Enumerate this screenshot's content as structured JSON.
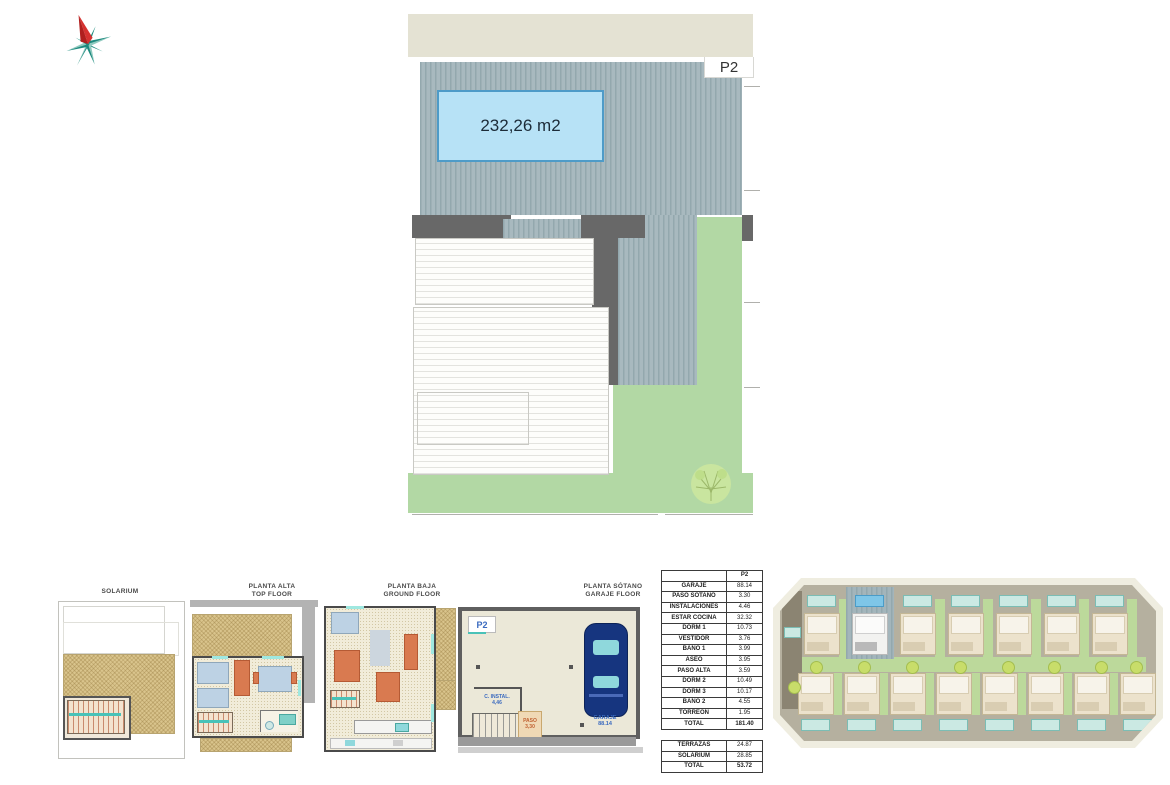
{
  "site_plan": {
    "plot_label": "P2",
    "area_label": "232,26 m2"
  },
  "floor_plans": [
    {
      "id": "solarium",
      "title_lines": [
        "SOLARIUM"
      ]
    },
    {
      "id": "planta-alta",
      "title_lines": [
        "PLANTA ALTA",
        "TOP FLOOR"
      ]
    },
    {
      "id": "planta-baja",
      "title_lines": [
        "PLANTA BAJA",
        "GROUND FLOOR"
      ]
    },
    {
      "id": "planta-sotano",
      "title_lines": [
        "PLANTA SÓTANO",
        "GARAJE FLOOR"
      ],
      "labels": {
        "plot": "P2",
        "instal_name": "C. INSTAL.",
        "instal_area": "4,46",
        "paso_name": "PASO",
        "paso_area": "3,30",
        "garaje_name": "GARAJE",
        "garaje_area": "88.14"
      }
    }
  ],
  "area_table": {
    "column_headers": [
      "",
      "P2"
    ],
    "rows": [
      [
        "GARAJE",
        "88.14"
      ],
      [
        "PASO SOTANO",
        "3.30"
      ],
      [
        "INSTALACIONES",
        "4.46"
      ],
      [
        "ESTAR COCINA",
        "32.32"
      ],
      [
        "DORM 1",
        "10.73"
      ],
      [
        "VESTIDOR",
        "3.76"
      ],
      [
        "BAÑO 1",
        "3.99"
      ],
      [
        "ASEO",
        "3.95"
      ],
      [
        "PASO ALTA",
        "3.59"
      ],
      [
        "DORM 2",
        "10.49"
      ],
      [
        "DORM 3",
        "10.17"
      ],
      [
        "BAÑO 2",
        "4.55"
      ],
      [
        "TORREÓN",
        "1.95"
      ]
    ],
    "total_row": [
      "TOTAL",
      "181.40"
    ],
    "exterior_rows": [
      [
        "TERRAZAS",
        "24.87"
      ],
      [
        "SOLARIUM",
        "28.85"
      ]
    ],
    "exterior_total_row": [
      "TOTAL",
      "53.72"
    ]
  },
  "site_overview": {
    "top_row_units": 7,
    "bottom_row_units": 8,
    "highlighted_unit_index": 1
  },
  "colors": {
    "pool_fill": "#b7e2f6",
    "pool_border": "#4e9bc8",
    "roof_deck": "#a8b9bf",
    "grass": "#b2d8a4",
    "wall_dark": "#686868",
    "road_beige": "#e4e2d3",
    "highlight_chip": "#7ec6e8"
  }
}
